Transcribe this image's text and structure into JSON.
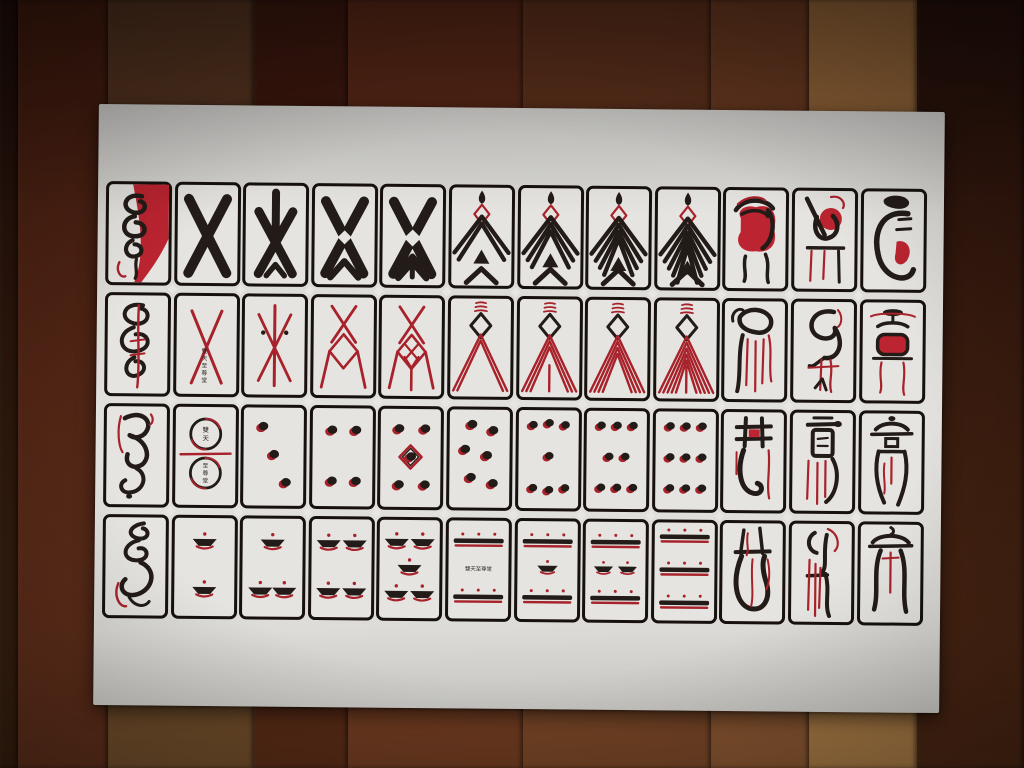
{
  "colors": {
    "ink_black": "#221b17",
    "ink_red": "#a8222b",
    "ink_red_bright": "#bb2430",
    "card_bg": "#e6e4e0",
    "card_border": "#17110d",
    "sheet_bg": "#dcdbd7",
    "text_dark": "#2b2420"
  },
  "floor_planks": [
    {
      "width": 18,
      "top": "#1f0d08",
      "bottom": "#38200f"
    },
    {
      "width": 90,
      "top": "#401a0e",
      "bottom": "#61301b"
    },
    {
      "width": 146,
      "top": "#50301e",
      "bottom": "#74502c"
    },
    {
      "width": 94,
      "top": "#38150c",
      "bottom": "#5c2d17"
    },
    {
      "width": 175,
      "top": "#532414",
      "bottom": "#743e22"
    },
    {
      "width": 188,
      "top": "#572c19",
      "bottom": "#7c4928"
    },
    {
      "width": 98,
      "top": "#64351e",
      "bottom": "#8c5832"
    },
    {
      "width": 108,
      "top": "#8f6136",
      "bottom": "#ab7c46"
    },
    {
      "width": 107,
      "top": "#26100a",
      "bottom": "#4c2713"
    }
  ],
  "maker_mark": "雙天至尊堂",
  "maker_mark_top": "雙天",
  "maker_mark_bottom": "至尊堂",
  "rows": [
    [
      {
        "glyph": "ace-man"
      },
      {
        "glyph": "x-figure",
        "level": 1
      },
      {
        "glyph": "x-figure",
        "level": 2
      },
      {
        "glyph": "x-figure",
        "level": 3
      },
      {
        "glyph": "x-figure",
        "level": 4
      },
      {
        "glyph": "chevron-man",
        "level": 2
      },
      {
        "glyph": "chevron-man",
        "level": 3
      },
      {
        "glyph": "chevron-man",
        "level": 4
      },
      {
        "glyph": "chevron-man",
        "level": 5
      },
      {
        "glyph": "court-red-robe"
      },
      {
        "glyph": "court-stool"
      },
      {
        "glyph": "court-tongue"
      }
    ],
    [
      {
        "glyph": "ace-spiral"
      },
      {
        "glyph": "red-x",
        "level": 1,
        "mark": true
      },
      {
        "glyph": "red-x",
        "level": 2
      },
      {
        "glyph": "red-x",
        "level": 3
      },
      {
        "glyph": "red-x",
        "level": 4
      },
      {
        "glyph": "red-chevron",
        "level": 2
      },
      {
        "glyph": "red-chevron",
        "level": 3
      },
      {
        "glyph": "red-chevron",
        "level": 4
      },
      {
        "glyph": "red-chevron",
        "level": 5
      },
      {
        "glyph": "court-hood"
      },
      {
        "glyph": "court-crane"
      },
      {
        "glyph": "court-red-seat"
      }
    ],
    [
      {
        "glyph": "ace-beast"
      },
      {
        "glyph": "coin-circles"
      },
      {
        "glyph": "dots",
        "count": 3
      },
      {
        "glyph": "dots",
        "count": 4
      },
      {
        "glyph": "dots",
        "count": 5
      },
      {
        "glyph": "dots",
        "count": 6
      },
      {
        "glyph": "dots",
        "count": 7
      },
      {
        "glyph": "dots",
        "count": 8
      },
      {
        "glyph": "dots",
        "count": 9
      },
      {
        "glyph": "court-gate"
      },
      {
        "glyph": "court-shell"
      },
      {
        "glyph": "court-tall"
      }
    ],
    [
      {
        "glyph": "ace-flag"
      },
      {
        "glyph": "bowls",
        "count": 2
      },
      {
        "glyph": "bowls",
        "count": 3
      },
      {
        "glyph": "bowls",
        "count": 4
      },
      {
        "glyph": "bowls",
        "count": 5
      },
      {
        "glyph": "bars",
        "bars": 2,
        "mark": true
      },
      {
        "glyph": "bars",
        "bars": 2,
        "mid": 1
      },
      {
        "glyph": "bars",
        "bars": 2,
        "mid": 2
      },
      {
        "glyph": "bars",
        "bars": 3
      },
      {
        "glyph": "court-jar"
      },
      {
        "glyph": "court-staff"
      },
      {
        "glyph": "court-crown"
      }
    ]
  ]
}
